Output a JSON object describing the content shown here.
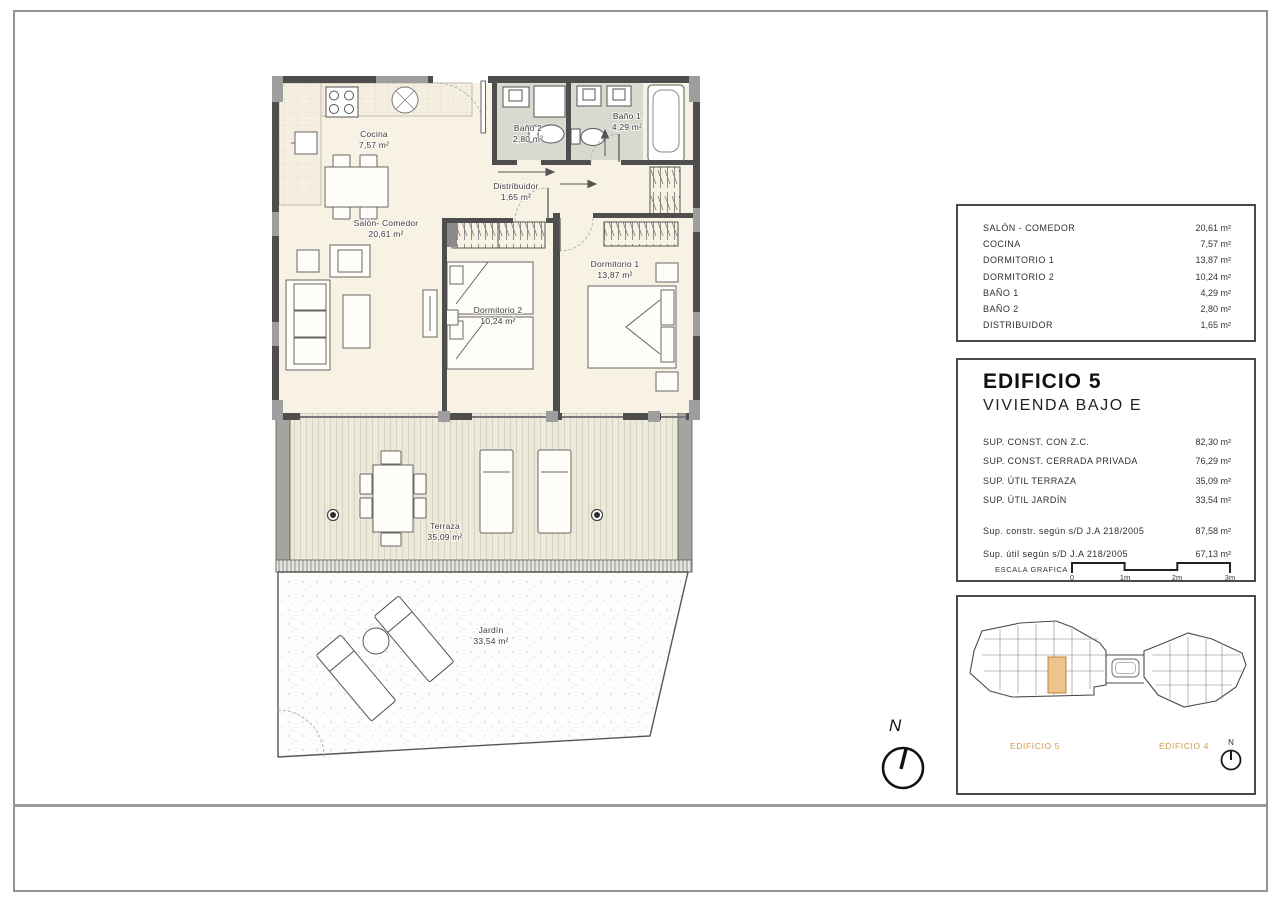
{
  "plan": {
    "cocina": {
      "name": "Cocina",
      "area": "7,57 m²"
    },
    "salon": {
      "name": "Salón- Comedor",
      "area": "20,61 m²"
    },
    "bano2": {
      "name": "Baño 2",
      "area": "2,80 m²"
    },
    "bano1": {
      "name": "Baño 1",
      "area": "4,29 m²"
    },
    "distribuidor": {
      "name": "Distribuidor",
      "area": "1,65 m²"
    },
    "dormitorio2": {
      "name": "Dormitorio 2",
      "area": "10,24 m²"
    },
    "dormitorio1": {
      "name": "Dormitorio 1",
      "area": "13,87 m²"
    },
    "terraza": {
      "name": "Terraza",
      "area": "35,09 m²"
    },
    "jardin": {
      "name": "Jardín",
      "area": "33,54 m²"
    }
  },
  "areas_table": {
    "rows": [
      {
        "label": "SALÓN - COMEDOR",
        "value": "20,61 m²"
      },
      {
        "label": "COCINA",
        "value": "7,57 m²"
      },
      {
        "label": "DORMITORIO 1",
        "value": "13,87 m²"
      },
      {
        "label": "DORMITORIO 2",
        "value": "10,24 m²"
      },
      {
        "label": "BAÑO 1",
        "value": "4,29 m²"
      },
      {
        "label": "BAÑO 2",
        "value": "2,80 m²"
      },
      {
        "label": "DISTRIBUIDOR",
        "value": "1,65 m²"
      }
    ]
  },
  "unit_panel": {
    "title": "EDIFICIO 5",
    "subtitle": "VIVIENDA BAJO E",
    "rows": [
      {
        "label": "SUP. CONST. CON Z.C.",
        "value": "82,30 m²"
      },
      {
        "label": "SUP. CONST. CERRADA PRIVADA",
        "value": "76,29 m²"
      },
      {
        "label": "SUP. ÚTIL TERRAZA",
        "value": "35,09 m²"
      },
      {
        "label": "SUP. ÚTIL JARDÍN",
        "value": "33,54 m²"
      }
    ],
    "legal_rows": [
      {
        "label": "Sup. constr. según s/D J.A 218/2005",
        "value": "87,58 m²"
      },
      {
        "label": "Sup. útil según s/D J.A 218/2005",
        "value": "67,13 m²"
      }
    ],
    "scale_label": "ESCALA GRAFICA",
    "scale_ticks": [
      "0",
      "1m",
      "2m",
      "3m"
    ]
  },
  "site_plan": {
    "building_labels": [
      "EDIFICIO 5",
      "EDIFICIO 4"
    ],
    "north_label": "N",
    "accent_color": "#cf9b4a",
    "highlight_color": "#f0c28c"
  },
  "compass": {
    "north_label": "N"
  },
  "colors": {
    "wall": "#4e4e4e",
    "pilaster": "#9e9e9e",
    "floor": "#f7f2e3",
    "bath_floor": "#d9d9cf",
    "accent": "#cf9b4a"
  }
}
